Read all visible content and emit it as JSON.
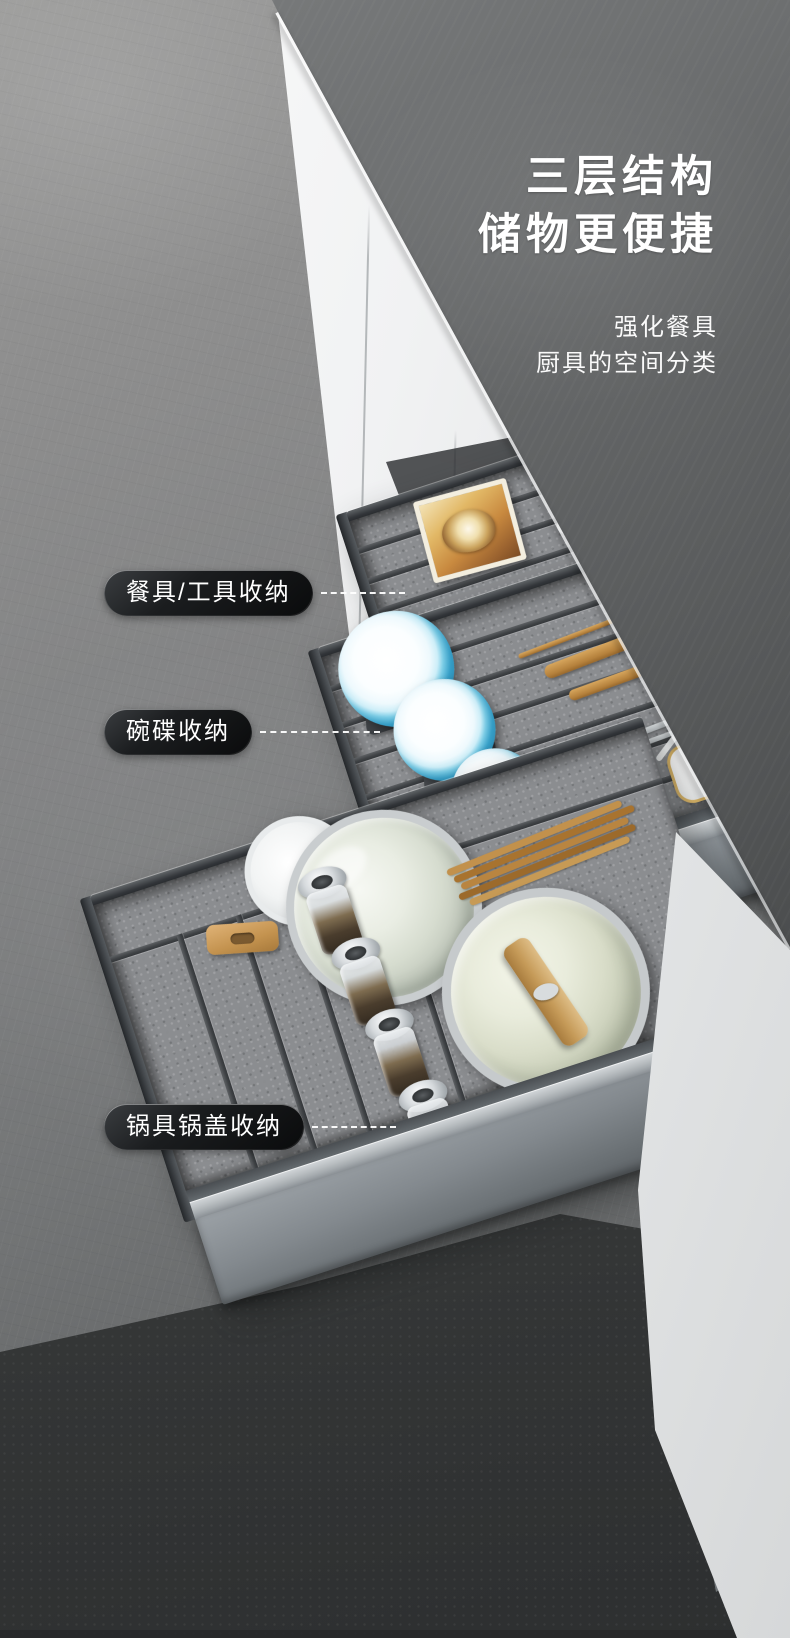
{
  "hero": {
    "title_line1": "三层结构",
    "title_line2": "储物更便捷",
    "subtitle_line1": "强化餐具",
    "subtitle_line2": "厨具的空间分类"
  },
  "callouts": [
    {
      "label": "餐具/工具收纳"
    },
    {
      "label": "碗碟收纳"
    },
    {
      "label": "锅具锅盖收纳"
    }
  ],
  "palette": {
    "wall_gray": "#8b8c8d",
    "countertop_charcoal": "#4b4d4f",
    "cabinet_white": "#f2f3f4",
    "drawer_metal_gray": "#82878b",
    "felt_liner_gray": "#8a8c8e",
    "callout_pill_black": "#121314",
    "text_white": "#ffffff",
    "bowl_blue": "#46b5dd",
    "wood_tan": "#c08d4e",
    "gold_trim": "#d5ab5f"
  }
}
